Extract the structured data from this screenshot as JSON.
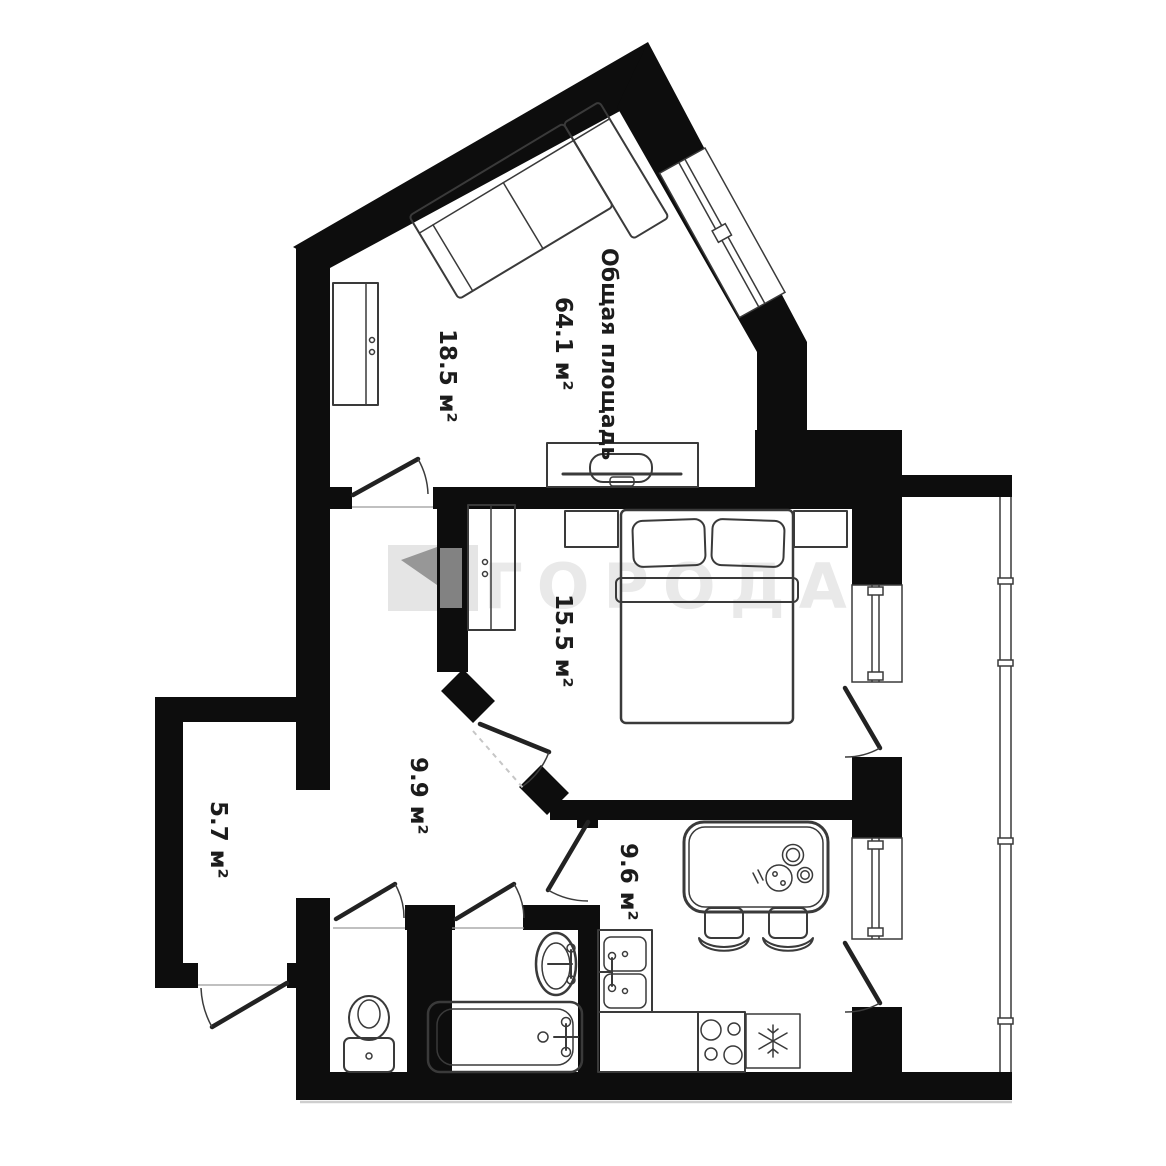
{
  "watermark": {
    "text": "ГОРОДА"
  },
  "plan": {
    "total": {
      "line1": "Общая площадь",
      "line2": "64.1 м²"
    },
    "rooms": {
      "living": "18.5 м²",
      "bedroom": "15.5 м²",
      "hallway": "9.9 м²",
      "balcony": "5.7 м²",
      "kitchen": "9.6 м²"
    }
  },
  "colors": {
    "wall": "#0d0d0d",
    "outline": "#3a3a3a",
    "label": "#1c1c1c",
    "wm": "#e9e9e9",
    "logo_light": "#e5e5e5",
    "logo_dark": "#8f8f8f"
  }
}
